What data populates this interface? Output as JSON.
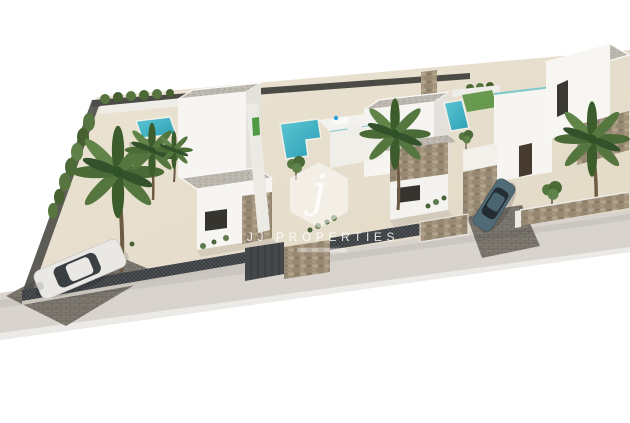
{
  "image": {
    "type": "3d-architectural-render",
    "description": "Aerial 3D render of a row of three modern white villas with private pools, palm trees, paved patios and fenced plots on a plain white background",
    "background_color": "#ffffff"
  },
  "watermark": {
    "monogram": "j",
    "brand": "JJ PROPERTIES"
  },
  "scene": {
    "villas_count": 3,
    "pools_count": 3,
    "palm_trees_count": 5,
    "cars": [
      {
        "color_name": "white",
        "hex": "#e9e8e5",
        "location": "front-left plot, parked inside fence"
      },
      {
        "color_name": "steel blue-gray",
        "hex": "#506b76",
        "location": "right villa driveway"
      }
    ],
    "features": [
      "turquoise private pools",
      "artificial lawn",
      "roof terraces with glass balustrade",
      "sun loungers",
      "gabion stone fence pillars",
      "dark mesh fencing",
      "gravel flat roofs",
      "stone-clad wall accents",
      "green front door",
      "hedge row along left boundary",
      "sidewalk along street front"
    ]
  },
  "palette": {
    "wall_white": "#f6f5f2",
    "wall_shade": "#e3e1db",
    "patio_cream": "#e9e1d0",
    "roof_gravel": "#bcb8af",
    "pool_turquoise": "#2fa9bd",
    "lawn_green": "#679a4e",
    "palm_green": "#4a6b36",
    "hedge_green": "#57763f",
    "fence_dark": "#4a4d4f",
    "stone_beige": "#9d8f7a",
    "paver_gray": "#7e7a71",
    "sidewalk_gray": "#d8d4cd",
    "door_green": "#4f9a43",
    "door_brown": "#473b30",
    "watermark_white": "#ffffff"
  }
}
